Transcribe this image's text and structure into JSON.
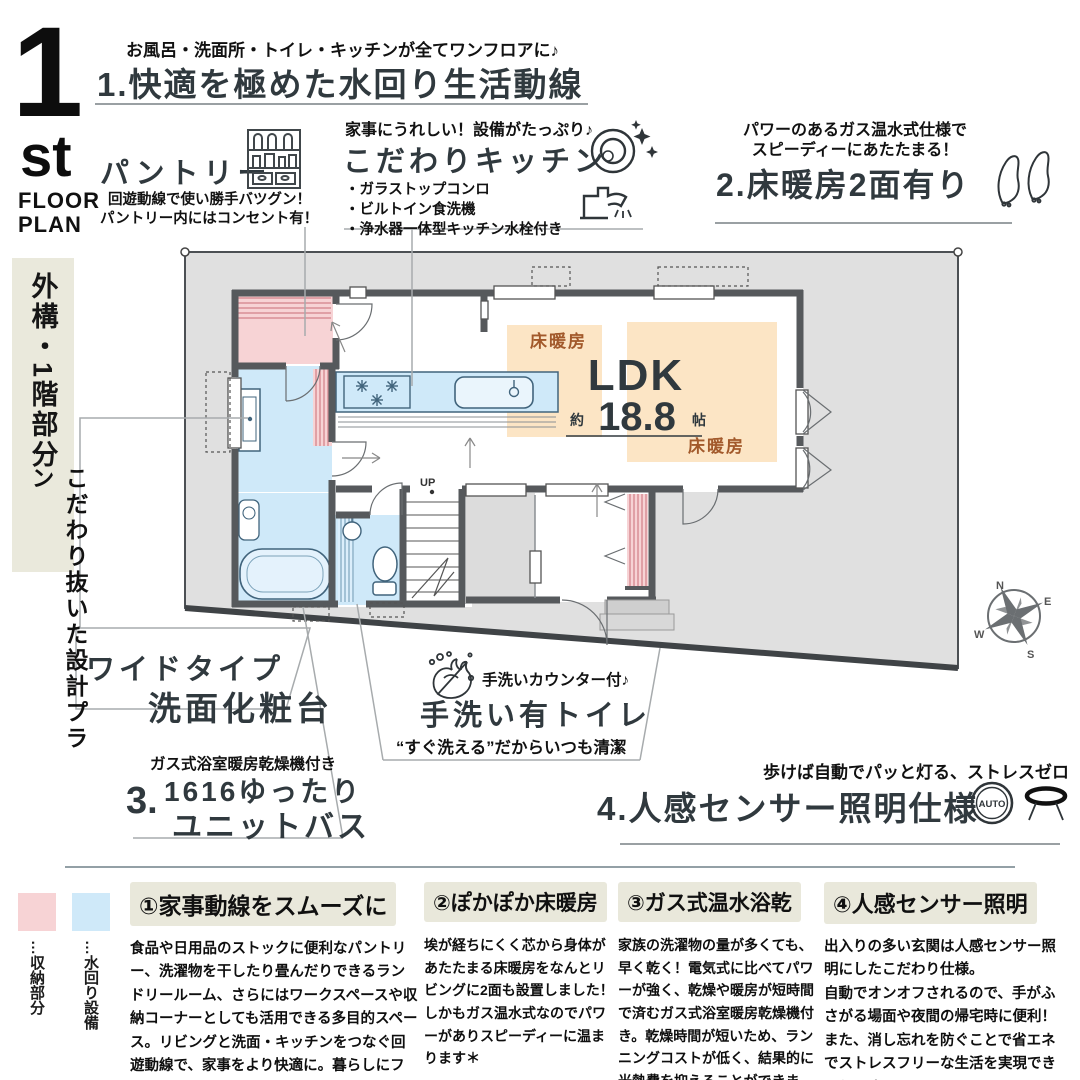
{
  "badge": {
    "number": "1",
    "ordinal": "st",
    "floor": "FLOOR",
    "plan": "PLAN"
  },
  "feature1": {
    "subtitle": "お風呂・洗面所・トイレ・キッチンが全てワンフロアに♪",
    "title": "1.快適を極めた水回り生活動線"
  },
  "pantry": {
    "title": "パントリー",
    "desc1": "回遊動線で使い勝手バツグン！",
    "desc2": "パントリー内にはコンセント有！"
  },
  "kitchen": {
    "subtitle": "家事にうれしい！設備がたっぷり♪",
    "title": "こだわりキッチン",
    "bullet1": "・ガラストップコンロ",
    "bullet2": "・ビルトイン食洗機",
    "bullet3": "・浄水器一体型キッチン水栓付き"
  },
  "feature2": {
    "subtitle1": "パワーのあるガス温水式仕様で",
    "subtitle2": "スピーディーにあたたまる！",
    "title": "2.床暖房2面有り"
  },
  "sidebar": {
    "box_label": "外構・1階部分",
    "tagline": "こだわり抜いた設計プラン"
  },
  "plan": {
    "ldk": "LDK",
    "approx": "約",
    "area": "18.8",
    "unit": "帖",
    "floorheat1": "床暖房",
    "floorheat2": "床暖房",
    "up": "UP",
    "compass": {
      "n": "N",
      "e": "E",
      "s": "S",
      "w": "W"
    }
  },
  "vanity": {
    "line1": "ワイドタイプ",
    "line2": "洗面化粧台"
  },
  "unitbath": {
    "note": "ガス式浴室暖房乾燥機付き",
    "num": "3.",
    "line1": "1616ゆったり",
    "line2": "ユニットバス"
  },
  "toilet": {
    "counter_note": "手洗いカウンター付♪",
    "title": "手洗い有トイレ",
    "clean_note": "“すぐ洗える”だからいつも清潔"
  },
  "feature4": {
    "subtitle": "歩けば自動でパッと灯る、ストレスゼロ",
    "title": "4.人感センサー照明仕様",
    "auto": "AUTO"
  },
  "legend": {
    "storage": "…収納部分",
    "water": "…水回り設備"
  },
  "columns": [
    {
      "title": "①家事動線をスムーズに",
      "body": "食品や日用品のストックに便利なパントリー、洗濯物を干したり畳んだりできるランドリールーム、さらにはワークスペースや収納コーナーとしても活用できる多目的スペース。リビングと洗面・キッチンをつなぐ回遊動線で、家事をより快適に。暮らしにフィットする柔軟なこだわり空間です。"
    },
    {
      "title": "②ぽかぽか床暖房",
      "body": "埃が経ちにくく芯から身体があたたまる床暖房をなんとリビングに2面も設置しました！しかもガス温水式なのでパワーがありスピーディーに温まります＊"
    },
    {
      "title": "③ガス式温水浴乾",
      "body": "家族の洗濯物の量が多くても、早く乾く！電気式に比べてパワーが強く、乾燥や暖房が短時間で済むガス式浴室暖房乾燥機付き。乾燥時間が短いため、ランニングコストが低く、結果的に光熱費を抑えることができます。"
    },
    {
      "title": "④人感センサー照明",
      "body": "出入りの多い玄関は人感センサー照明にしたこだわり仕様。\n自動でオンオフされるので、手がふさがる場面や夜間の帰宅時に便利！また、消し忘れを防ぐことで省エネでストレスフリーな生活を実現できそうです♪"
    }
  ],
  "colors": {
    "storage_pink": "#f7d3d5",
    "water_blue": "#cfe9f9",
    "floorheat_orange": "#fce5c5",
    "heading_ink": "#30393e",
    "label_brown": "#a2592b",
    "beige": "#e9e8db",
    "wall": "#56595c",
    "site_gray": "#e0e0e0"
  }
}
